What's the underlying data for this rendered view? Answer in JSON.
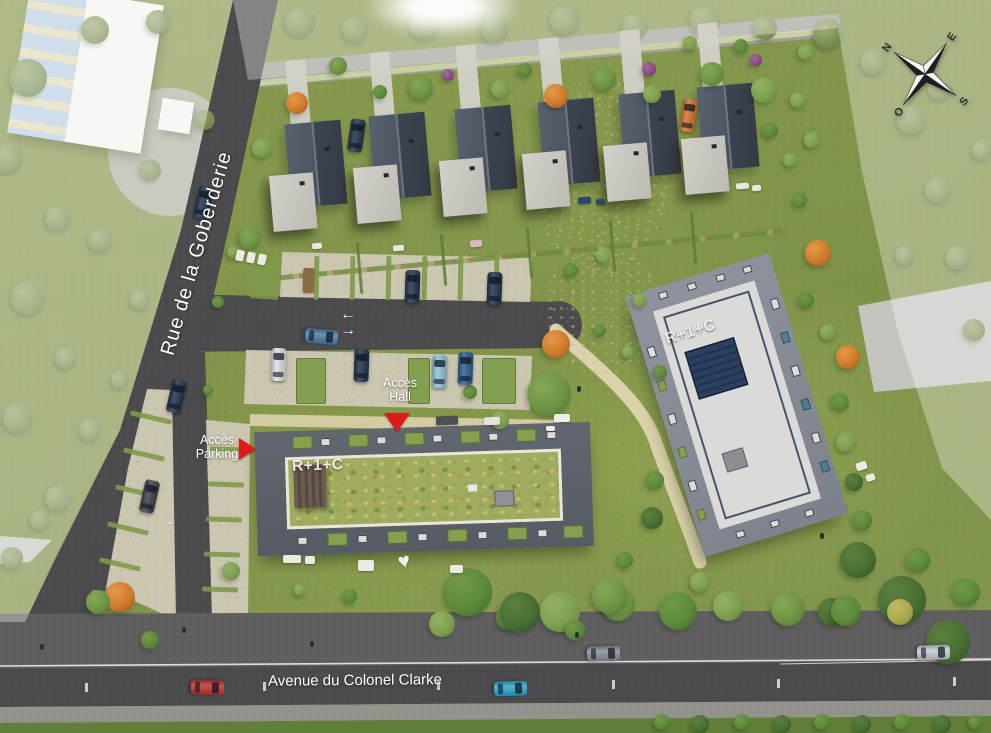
{
  "labels": {
    "street_left": "Rue de la Goberderie",
    "street_bottom": "Avenue du Colonel Clarke",
    "building_a": "R+1+C",
    "building_b": "R+1+C",
    "access_hall_line1": "Accès",
    "access_hall_line2": "Hall",
    "access_parking_line1": "Accès",
    "access_parking_line2": "Parking"
  },
  "compass": {
    "n": "N",
    "e": "E",
    "s": "S",
    "w": "O"
  },
  "markers": {
    "hall_arrow": "down",
    "parking_arrow": "right",
    "road_arrows": [
      "left",
      "right",
      "up"
    ]
  },
  "colors": {
    "marker_red": "#dd1a1a",
    "grass": "#85984e",
    "asphalt": "#4d4d4f",
    "parking_pave": "#cbc6af",
    "path": "#dbd2ab",
    "building_a_border": "#5d626b",
    "building_a_green_roof": "#a2ac60",
    "building_b_border": "#8d919b",
    "building_b_roof": "#dadad8",
    "solar_panel": "#2b3f5e",
    "house_roof_dark": "#3c434e",
    "house_roof_light": "#58616f",
    "annex_roof": "#cdcac4"
  },
  "scene": {
    "tree_palette": {
      "g1": [
        "#86a855",
        "#6d9444",
        "#4f7534"
      ],
      "g2": [
        "#95b163",
        "#7da04f",
        "#5a8040"
      ],
      "g3": [
        "#74984a",
        "#5c8a3b",
        "#42682c"
      ],
      "dk": [
        "#5d8040",
        "#486f33",
        "#2f4f22"
      ],
      "or": [
        "#e59a4a",
        "#cf7a2c",
        "#9c5a20"
      ],
      "pu": [
        "#a06a9c",
        "#8a4c85",
        "#5f3060"
      ],
      "yl": [
        "#c2bb60",
        "#a8a94e",
        "#7d8038"
      ],
      "mut": [
        "#9aab72",
        "#7e9156",
        "#5f7444"
      ]
    },
    "trees": [
      [
        262,
        148,
        10,
        "g2"
      ],
      [
        297,
        103,
        11,
        "or"
      ],
      [
        338,
        66,
        9,
        "g1"
      ],
      [
        380,
        92,
        7,
        "g3"
      ],
      [
        421,
        88,
        12,
        "g1"
      ],
      [
        448,
        75,
        6,
        "pu"
      ],
      [
        500,
        89,
        9,
        "g2"
      ],
      [
        525,
        70,
        7,
        "g3"
      ],
      [
        556,
        96,
        12,
        "or"
      ],
      [
        604,
        79,
        12,
        "g1"
      ],
      [
        649,
        69,
        7,
        "pu"
      ],
      [
        652,
        94,
        9,
        "g2"
      ],
      [
        712,
        74,
        12,
        "g1"
      ],
      [
        756,
        60,
        6,
        "pu"
      ],
      [
        764,
        90,
        13,
        "g2"
      ],
      [
        806,
        52,
        8,
        "g2"
      ],
      [
        741,
        46,
        7,
        "g3"
      ],
      [
        690,
        43,
        7,
        "g2"
      ],
      [
        770,
        130,
        8,
        "g3"
      ],
      [
        790,
        160,
        7,
        "g2"
      ],
      [
        798,
        100,
        8,
        "g2"
      ],
      [
        800,
        200,
        7,
        "g3"
      ],
      [
        250,
        238,
        11,
        "g1"
      ],
      [
        233,
        252,
        6,
        "g2"
      ],
      [
        218,
        302,
        6,
        "g3"
      ],
      [
        208,
        390,
        5,
        "g3"
      ],
      [
        120,
        597,
        15,
        "or"
      ],
      [
        98,
        602,
        12,
        "g1"
      ],
      [
        150,
        640,
        9,
        "g3"
      ],
      [
        231,
        571,
        9,
        "g2"
      ],
      [
        549,
        394,
        22,
        "g1"
      ],
      [
        556,
        344,
        14,
        "or"
      ],
      [
        500,
        420,
        9,
        "g2"
      ],
      [
        470,
        392,
        7,
        "g3"
      ],
      [
        604,
        255,
        8,
        "g2"
      ],
      [
        571,
        270,
        7,
        "g3"
      ],
      [
        640,
        300,
        7,
        "g2"
      ],
      [
        600,
        330,
        6,
        "g3"
      ],
      [
        628,
        352,
        6,
        "g2"
      ],
      [
        660,
        372,
        7,
        "g3"
      ],
      [
        655,
        480,
        9,
        "g3"
      ],
      [
        652,
        518,
        11,
        "dk"
      ],
      [
        700,
        582,
        10,
        "g2"
      ],
      [
        625,
        560,
        8,
        "g3"
      ],
      [
        812,
        140,
        8,
        "g2"
      ],
      [
        818,
        253,
        13,
        "or"
      ],
      [
        806,
        300,
        8,
        "g3"
      ],
      [
        828,
        332,
        8,
        "g2"
      ],
      [
        848,
        357,
        12,
        "or"
      ],
      [
        840,
        402,
        9,
        "g3"
      ],
      [
        846,
        442,
        10,
        "g2"
      ],
      [
        854,
        482,
        9,
        "dk"
      ],
      [
        862,
        520,
        10,
        "g3"
      ],
      [
        858,
        560,
        18,
        "dk"
      ],
      [
        902,
        600,
        24,
        "dk"
      ],
      [
        948,
        642,
        22,
        "dk"
      ],
      [
        832,
        612,
        14,
        "dk"
      ],
      [
        966,
        592,
        14,
        "g3"
      ],
      [
        918,
        560,
        12,
        "g3"
      ],
      [
        560,
        612,
        20,
        "g2"
      ],
      [
        618,
        604,
        17,
        "g1"
      ],
      [
        678,
        611,
        19,
        "g3"
      ],
      [
        728,
        606,
        15,
        "g2"
      ],
      [
        788,
        609,
        17,
        "g1"
      ],
      [
        846,
        611,
        15,
        "g3"
      ],
      [
        900,
        612,
        13,
        "yl"
      ],
      [
        508,
        618,
        12,
        "g3"
      ],
      [
        468,
        592,
        24,
        "g3"
      ],
      [
        520,
        612,
        20,
        "dk"
      ],
      [
        610,
        596,
        18,
        "g1"
      ],
      [
        442,
        624,
        13,
        "g2"
      ],
      [
        575,
        630,
        10,
        "g3"
      ],
      [
        350,
        596,
        7,
        "g3"
      ],
      [
        300,
        590,
        6,
        "g2"
      ],
      [
        662,
        722,
        8,
        "g3"
      ],
      [
        700,
        724,
        9,
        "dk"
      ],
      [
        742,
        722,
        8,
        "g3"
      ],
      [
        782,
        724,
        9,
        "dk"
      ],
      [
        822,
        722,
        8,
        "g3"
      ],
      [
        862,
        724,
        9,
        "dk"
      ],
      [
        902,
        722,
        8,
        "g3"
      ],
      [
        942,
        724,
        9,
        "dk"
      ],
      [
        975,
        722,
        7,
        "g3"
      ]
    ],
    "outer_trees": [
      [
        300,
        22,
        15
      ],
      [
        355,
        30,
        13
      ],
      [
        425,
        24,
        16
      ],
      [
        495,
        30,
        13
      ],
      [
        565,
        20,
        15
      ],
      [
        635,
        26,
        13
      ],
      [
        705,
        20,
        15
      ],
      [
        765,
        28,
        12
      ],
      [
        828,
        34,
        15
      ],
      [
        874,
        62,
        13
      ],
      [
        912,
        120,
        15
      ],
      [
        938,
        190,
        13
      ],
      [
        958,
        258,
        12
      ],
      [
        974,
        330,
        11
      ],
      [
        940,
        88,
        12
      ],
      [
        982,
        150,
        10
      ],
      [
        905,
        255,
        10
      ],
      [
        28,
        78,
        19
      ],
      [
        8,
        158,
        15
      ],
      [
        58,
        218,
        13
      ],
      [
        28,
        298,
        17
      ],
      [
        66,
        358,
        11
      ],
      [
        18,
        418,
        15
      ],
      [
        58,
        498,
        13
      ],
      [
        12,
        558,
        11
      ],
      [
        95,
        30,
        14
      ],
      [
        158,
        22,
        12
      ],
      [
        205,
        120,
        10
      ],
      [
        150,
        170,
        11
      ],
      [
        100,
        240,
        12
      ],
      [
        140,
        300,
        10
      ],
      [
        90,
        430,
        11
      ],
      [
        120,
        380,
        9
      ],
      [
        40,
        520,
        10
      ]
    ],
    "cars": [
      [
        196,
        186,
        13,
        "#22354e"
      ],
      [
        349,
        119,
        8,
        "#22354e"
      ],
      [
        681,
        99,
        8,
        "#d4742e"
      ],
      [
        405,
        270,
        2,
        "#22354e"
      ],
      [
        487,
        272,
        2,
        "#22354e"
      ],
      [
        314,
        320,
        95,
        "#4d7fa3"
      ],
      [
        271,
        348,
        2,
        "#dfe2e4"
      ],
      [
        354,
        349,
        2,
        "#22354e"
      ],
      [
        432,
        355,
        2,
        "#8fc3dc"
      ],
      [
        458,
        352,
        2,
        "#2f5f93"
      ],
      [
        169,
        380,
        13,
        "#22354e"
      ],
      [
        142,
        480,
        13,
        "#3f4449"
      ],
      [
        200,
        671,
        92,
        "#c03434"
      ],
      [
        503,
        672,
        88,
        "#2fa7cc"
      ],
      [
        596,
        637,
        88,
        "#8d9298"
      ],
      [
        926,
        636,
        88,
        "#c8ccd0"
      ]
    ],
    "houses": [
      [
        288,
        122
      ],
      [
        372,
        114
      ],
      [
        458,
        107
      ],
      [
        541,
        100
      ],
      [
        622,
        92
      ],
      [
        700,
        85
      ]
    ],
    "house_angle": -5,
    "hedges": [
      [
        358,
        242
      ],
      [
        442,
        234
      ],
      [
        528,
        227
      ],
      [
        611,
        220
      ],
      [
        692,
        212
      ]
    ],
    "upper_dividers": [
      314,
      350,
      386,
      422,
      458,
      494
    ],
    "lower_greens": [
      [
        296,
        358,
        30,
        46
      ],
      [
        408,
        358,
        22,
        46
      ],
      [
        482,
        358,
        34,
        46
      ]
    ],
    "west_strips": [
      [
        150,
        415
      ],
      [
        143,
        452
      ],
      [
        135,
        489
      ],
      [
        127,
        526
      ],
      [
        119,
        562
      ],
      [
        111,
        594
      ]
    ],
    "east_strips": [
      [
        228,
        447
      ],
      [
        226,
        482
      ],
      [
        224,
        517
      ],
      [
        222,
        552
      ],
      [
        220,
        587
      ]
    ],
    "furniture": [
      [
        236,
        250,
        8,
        11,
        "#eceae2",
        13
      ],
      [
        247,
        252,
        8,
        11,
        "#eceae2",
        13
      ],
      [
        258,
        254,
        8,
        11,
        "#eceae2",
        13
      ],
      [
        303,
        268,
        11,
        25,
        "#8a6a42",
        2
      ],
      [
        312,
        243,
        10,
        6,
        "#e8e6de",
        -5
      ],
      [
        393,
        245,
        11,
        6,
        "#e8e6de",
        -5
      ],
      [
        470,
        240,
        12,
        7,
        "#d9b8c4",
        -5
      ],
      [
        578,
        197,
        13,
        7,
        "#2e4763",
        -5
      ],
      [
        596,
        199,
        9,
        6,
        "#2e4763",
        -5
      ],
      [
        736,
        183,
        13,
        6,
        "#e8e6de",
        -5
      ],
      [
        752,
        185,
        9,
        6,
        "#e8e6de",
        -5
      ],
      [
        436,
        416,
        22,
        9,
        "#4b5056",
        -2
      ],
      [
        484,
        417,
        16,
        8,
        "#e4e4de",
        -2
      ],
      [
        554,
        414,
        16,
        8,
        "#efeee6",
        0
      ],
      [
        546,
        426,
        9,
        5,
        "#efeee6",
        0
      ],
      [
        283,
        555,
        18,
        8,
        "#eceae2",
        0
      ],
      [
        305,
        556,
        10,
        8,
        "#eceae2",
        0
      ],
      [
        358,
        560,
        16,
        11,
        "#eceae2",
        0
      ],
      [
        450,
        565,
        13,
        8,
        "#eceae2",
        0
      ],
      [
        856,
        462,
        11,
        8,
        "#eceae2",
        -17
      ],
      [
        866,
        474,
        9,
        7,
        "#eceae2",
        -17
      ]
    ],
    "people": [
      [
        40,
        644
      ],
      [
        182,
        627
      ],
      [
        310,
        641
      ],
      [
        575,
        632
      ],
      [
        577,
        386
      ],
      [
        820,
        533
      ]
    ],
    "a_cells_top": [
      [
        38,
        "g"
      ],
      [
        66,
        "s"
      ],
      [
        94,
        "g"
      ],
      [
        122,
        "s"
      ],
      [
        150,
        "g"
      ],
      [
        178,
        "s"
      ],
      [
        206,
        "g"
      ],
      [
        234,
        "s"
      ],
      [
        262,
        "g"
      ],
      [
        292,
        "s"
      ]
    ],
    "a_cells_bottom": [
      [
        40,
        "s"
      ],
      [
        70,
        "g"
      ],
      [
        100,
        "s"
      ],
      [
        130,
        "g"
      ],
      [
        160,
        "s"
      ],
      [
        190,
        "g"
      ],
      [
        220,
        "s"
      ],
      [
        250,
        "g"
      ],
      [
        280,
        "s"
      ],
      [
        306,
        "g"
      ]
    ],
    "b_top": [
      32,
      62,
      92,
      120
    ],
    "b_bottom": [
      36,
      72,
      108
    ],
    "b_left": [
      55,
      90,
      125,
      160,
      195,
      225
    ],
    "b_right": [
      45,
      80,
      115,
      150,
      185,
      215
    ]
  }
}
